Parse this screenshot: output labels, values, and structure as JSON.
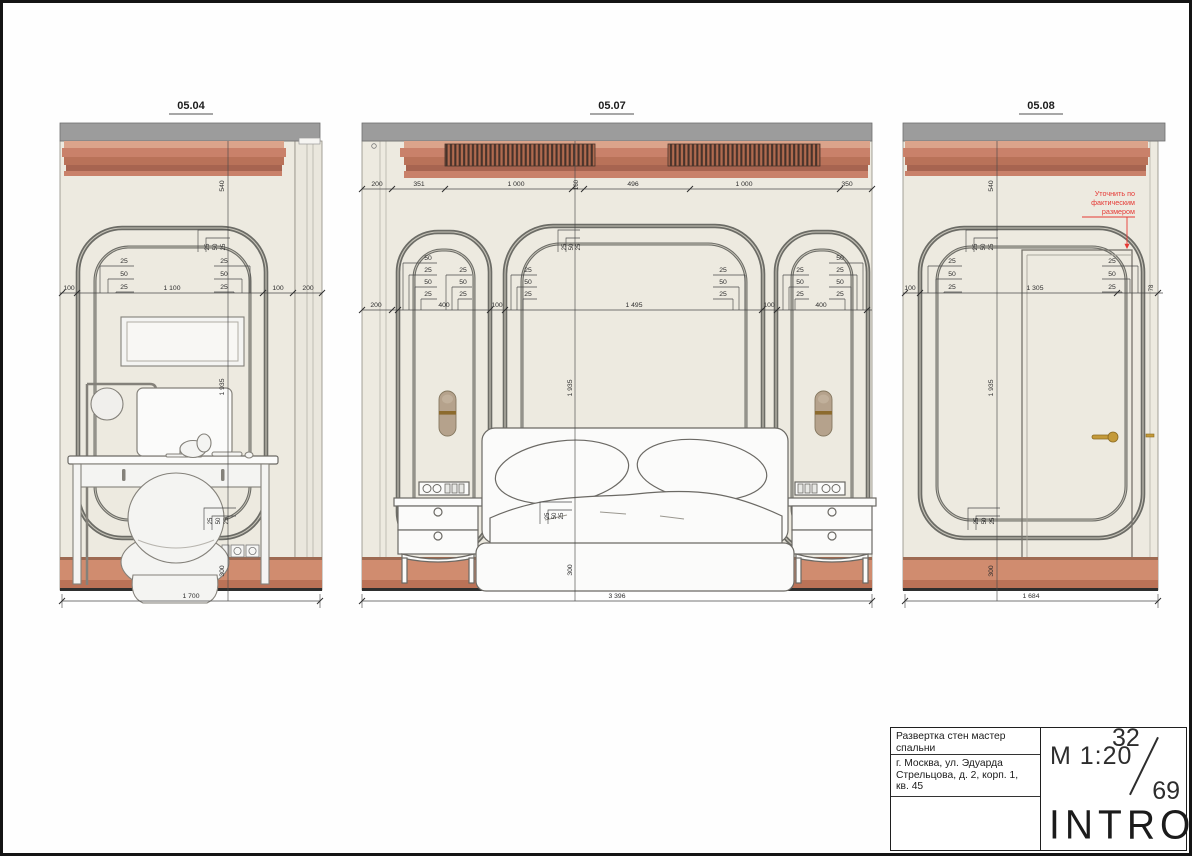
{
  "title_block": {
    "title_line1": "Развертка стен мастер",
    "title_line2": "спальни",
    "addr_line1": "г. Москва, ул. Эдуарда",
    "addr_line2": "Стрельцова, д. 2, корп. 1,",
    "addr_line3": "кв. 45",
    "scale": "М 1:20",
    "sheet_number": "32",
    "sheet_total": "69",
    "brand": "INTRO"
  },
  "note": {
    "line1": "Уточнить по",
    "line2": "фактическим",
    "line3": "размером"
  },
  "colors": {
    "terracotta": "#c9816a",
    "ceiling_gray": "#9c9c9c",
    "wall_cream": "#edeae0",
    "molding_gray": "#6c6c66",
    "brass": "#c49a39",
    "note_red": "#e53935"
  },
  "el1": {
    "label": "05.04",
    "dim_top": "540",
    "stack_center": [
      "25",
      "50",
      "25"
    ],
    "stack_left": [
      "25",
      "50",
      "25"
    ],
    "stack_right": [
      "25",
      "50",
      "25"
    ],
    "row": [
      "100",
      "1 100",
      "100",
      "200"
    ],
    "dim_height": "1 935",
    "stack_bottom": [
      "25",
      "50",
      "25"
    ],
    "dim_base": "300",
    "dim_width": "1 700"
  },
  "el2": {
    "label": "05.07",
    "row_top": [
      "200",
      "351",
      "1 000",
      "160",
      "496",
      "1 000",
      "350"
    ],
    "row_mid": [
      "200",
      "400",
      "100",
      "1 495",
      "100",
      "400"
    ],
    "stack_center": [
      "25",
      "50",
      "25"
    ],
    "stacks": [
      [
        "50",
        "25",
        "50",
        "25"
      ],
      [
        "25",
        "50",
        "25"
      ],
      [
        "25",
        "50",
        "25"
      ],
      [
        "25",
        "50",
        "25"
      ],
      [
        "25",
        "50",
        "25"
      ],
      [
        "50",
        "25",
        "50",
        "25"
      ]
    ],
    "dim_height": "1 935",
    "stack_bottom": [
      "25",
      "50",
      "25"
    ],
    "dim_base": "300",
    "dim_width": "3 396"
  },
  "el3": {
    "label": "05.08",
    "dim_top": "540",
    "stack_center": [
      "25",
      "50",
      "25"
    ],
    "stack_left": [
      "25",
      "50",
      "25"
    ],
    "stack_right": [
      "25",
      "50",
      "25"
    ],
    "row": [
      "100",
      "1 305",
      "78"
    ],
    "dim_height": "1 935",
    "stack_bottom": [
      "25",
      "50",
      "25"
    ],
    "dim_base": "300",
    "dim_width": "1 684"
  }
}
